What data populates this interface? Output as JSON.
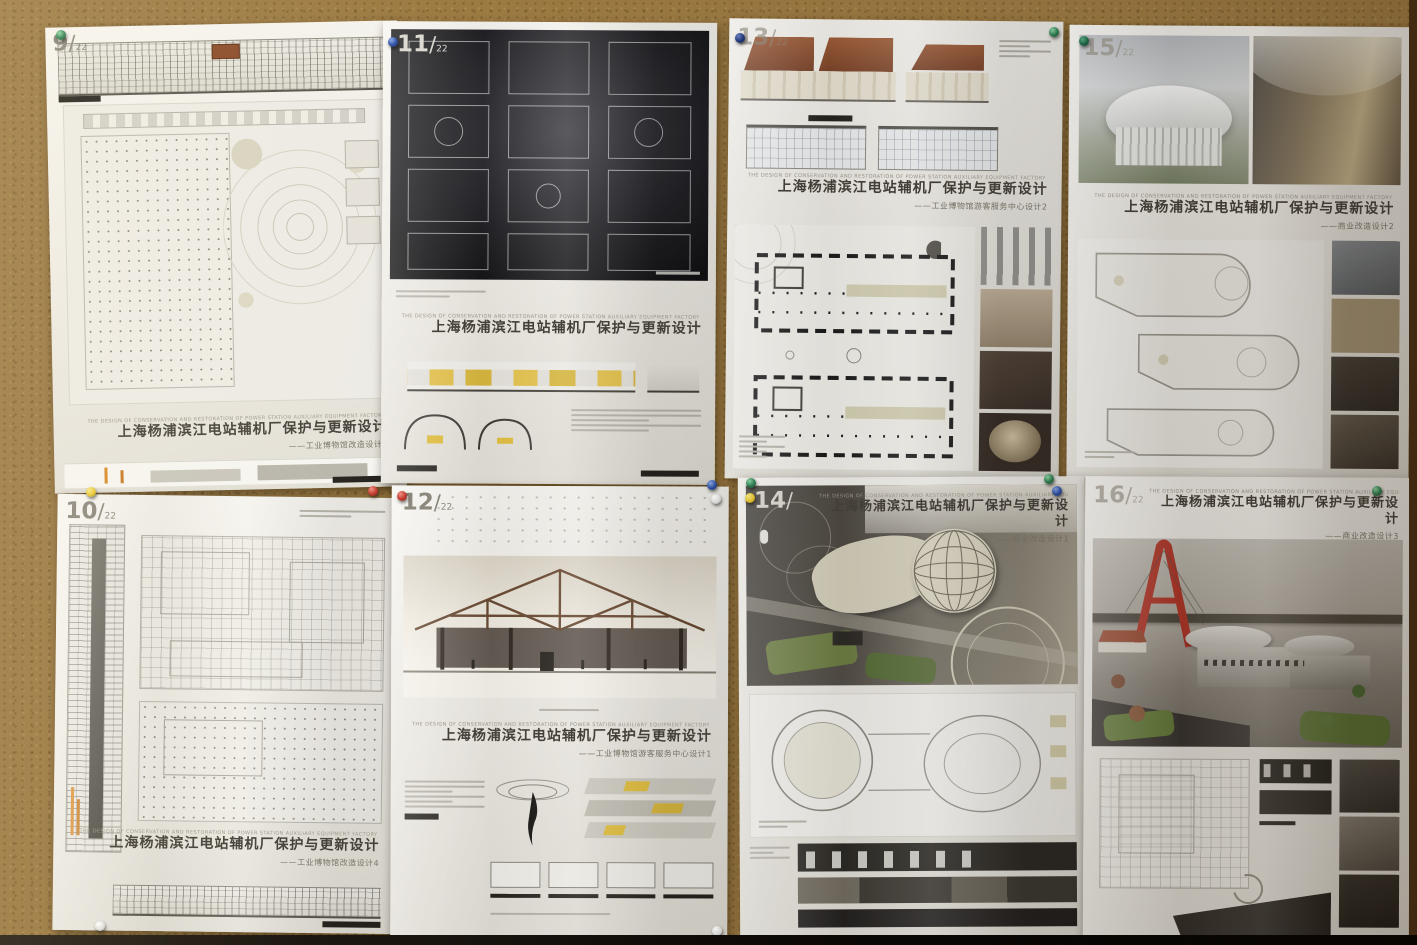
{
  "palette": {
    "cork_board": "#9c7a42",
    "paper": "#f2efe9",
    "accent_yellow": "#e4c24a",
    "roof_brown": "#8a5438",
    "bridge_red": "#b5372a",
    "plan_black": "#1a1a1a",
    "pin_colors": [
      "#2e7d4f",
      "#2b4fa0",
      "#223a7a",
      "#c23a2e",
      "#e6c731",
      "#e8e8e4"
    ]
  },
  "posters": [
    {
      "number": "9",
      "total": "22",
      "strapline": "THE DESIGN OF CONSERVATION AND RESTORATION OF POWER STATION AUXILIARY EQUIPMENT FACTORY IN SHANGHAI NEW YANGPU RIVER",
      "title": "上海杨浦滨江电站辅机厂保护与更新设计",
      "subtitle": "——工业博物馆改造设计3"
    },
    {
      "number": "11",
      "total": "22",
      "strapline": "THE DESIGN OF CONSERVATION AND RESTORATION OF POWER STATION AUXILIARY EQUIPMENT FACTORY IN SHANGHAI NEW YANGPU RIVER",
      "title": "上海杨浦滨江电站辅机厂保护与更新设计",
      "subtitle": ""
    },
    {
      "number": "13",
      "total": "22",
      "strapline": "THE DESIGN OF CONSERVATION AND RESTORATION OF POWER STATION AUXILIARY EQUIPMENT FACTORY IN SHANGHAI NEW YANGPU RIVER",
      "title": "上海杨浦滨江电站辅机厂保护与更新设计",
      "subtitle": "——工业博物馆游客服务中心设计2"
    },
    {
      "number": "15",
      "total": "22",
      "strapline": "THE DESIGN OF CONSERVATION AND RESTORATION OF POWER STATION AUXILIARY EQUIPMENT FACTORY IN SHANGHAI NEW YANGPU RIVER",
      "title": "上海杨浦滨江电站辅机厂保护与更新设计",
      "subtitle": "——商业改造设计2"
    },
    {
      "number": "10",
      "total": "22",
      "strapline": "THE DESIGN OF CONSERVATION AND RESTORATION OF POWER STATION AUXILIARY EQUIPMENT FACTORY IN SHANGHAI NEW YANGPU RIVER",
      "title": "上海杨浦滨江电站辅机厂保护与更新设计",
      "subtitle": "——工业博物馆改造设计4"
    },
    {
      "number": "12",
      "total": "22",
      "strapline": "THE DESIGN OF CONSERVATION AND RESTORATION OF POWER STATION AUXILIARY EQUIPMENT FACTORY IN SHANGHAI NEW YANGPU RIVER",
      "title": "上海杨浦滨江电站辅机厂保护与更新设计",
      "subtitle": "——工业博物馆游客服务中心设计1"
    },
    {
      "number": "14",
      "total": "22",
      "strapline": "THE DESIGN OF CONSERVATION AND RESTORATION OF POWER STATION AUXILIARY EQUIPMENT FACTORY IN SHANGHAI NEW YANGPU RIVER",
      "title": "上海杨浦滨江电站辅机厂保护与更新设计",
      "subtitle": "——商业改造设计1"
    },
    {
      "number": "16",
      "total": "22",
      "strapline": "THE DESIGN OF CONSERVATION AND RESTORATION OF POWER STATION AUXILIARY EQUIPMENT FACTORY IN SHANGHAI NEW YANGPU RIVER",
      "title": "上海杨浦滨江电站辅机厂保护与更新设计",
      "subtitle": "——商业改造设计3"
    }
  ]
}
